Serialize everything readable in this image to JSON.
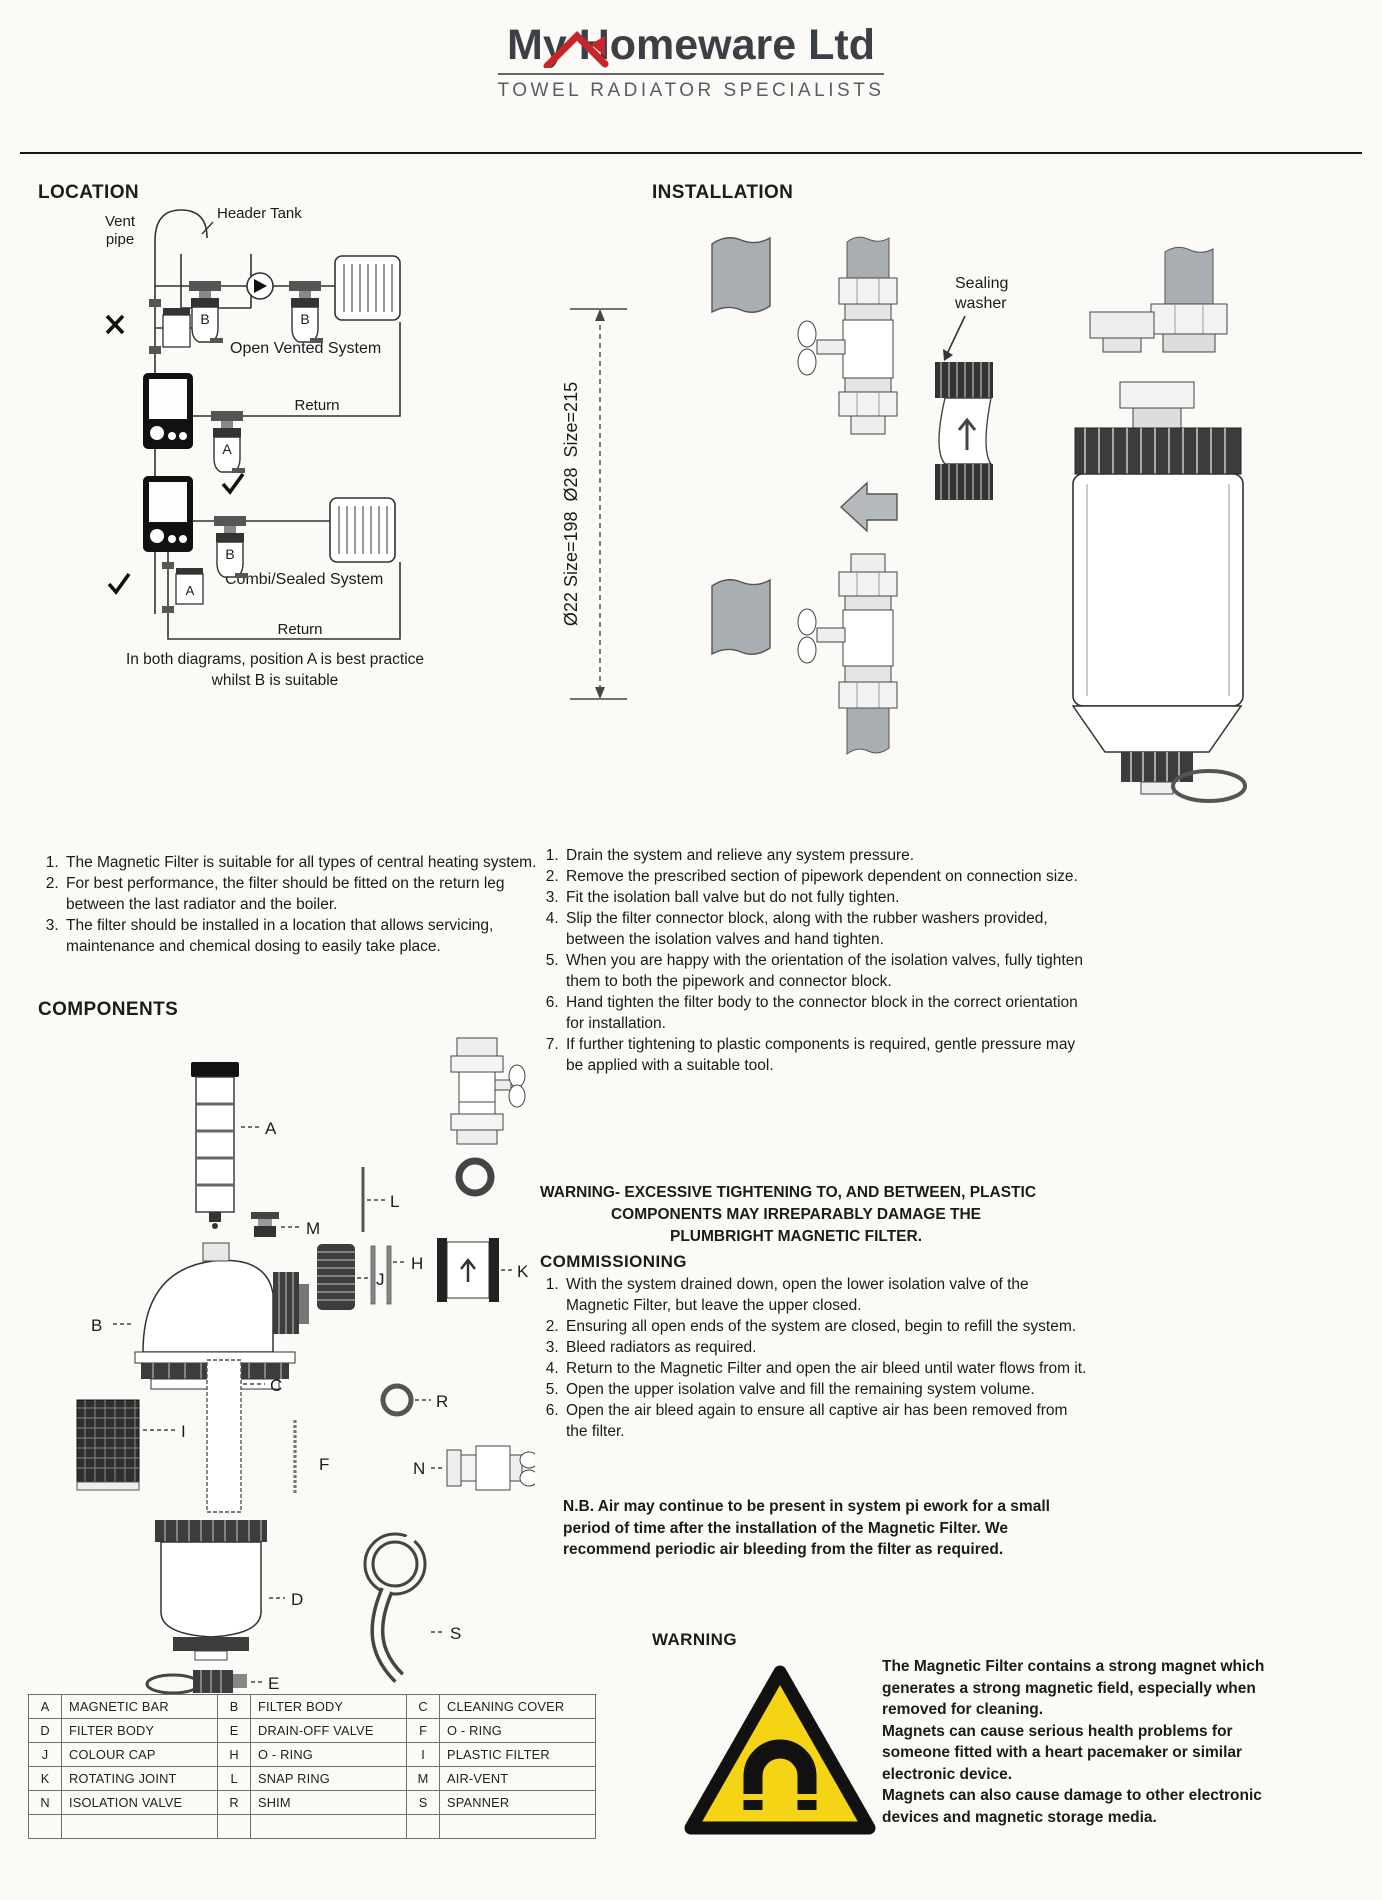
{
  "header": {
    "brand": "My Homeware Ltd",
    "tagline": "TOWEL RADIATOR SPECIALISTS"
  },
  "location": {
    "title": "LOCATION",
    "diagram": {
      "vent_line1": "Vent",
      "vent_line2": "pipe",
      "header_tank": "Header Tank",
      "open_vented_system": "Open Vented System",
      "return_top": "Return",
      "combi_sealed_system": "Combi/Sealed System",
      "return_bottom": "Return",
      "filter_b1": "B",
      "filter_b2": "B",
      "filter_a1": "A",
      "filter_b3": "B",
      "filter_a2": "A"
    },
    "caption": [
      "In both diagrams, position A is best practice",
      "whilst B is suitable"
    ],
    "notes": [
      "The Magnetic Filter is suitable for all types of central heating system.",
      "For best performance, the filter should be fitted on the return leg between the last radiator and the boiler.",
      "The filter should be installed in a location that allows servicing, maintenance and chemical dosing to easily take place."
    ]
  },
  "installation": {
    "title": "INSTALLATION",
    "diagram": {
      "sealing_line1": "Sealing",
      "sealing_line2": "washer",
      "dimension": "Ø22 Size=198  Ø28  Size=215"
    },
    "steps": [
      "Drain the system and relieve any system pressure.",
      "Remove the prescribed section of pipework dependent on connection size.",
      "Fit the isolation ball valve but do not fully tighten.",
      "Slip the filter connector block, along with the rubber washers provided, between the isolation valves and hand tighten.",
      "When you are happy with the orientation of the isolation valves, fully tighten them to both the pipework and connector block.",
      "Hand tighten the filter body to the connector block in the correct orientation for installation.",
      "If further tightening to plastic components is required, gentle pressure may be applied with a suitable tool."
    ]
  },
  "warning_tightening": {
    "lines": [
      "WARNING- EXCESSIVE TIGHTENING TO, AND BETWEEN, PLASTIC",
      "COMPONENTS MAY IRREPARABLY DAMAGE THE",
      "PLUMBRIGHT MAGNETIC FILTER."
    ]
  },
  "commissioning": {
    "title": "COMMISSIONING",
    "steps": [
      "With the system drained down, open the lower isolation valve of the Magnetic Filter, but leave the upper closed.",
      "Ensuring all open ends of the system are closed, begin to refill the system.",
      "Bleed radiators as required.",
      "Return to the Magnetic Filter and open the air bleed until water flows from it.",
      "Open the upper isolation valve and fill the remaining system volume.",
      "Open the air bleed again to ensure all captive air has been removed from the filter."
    ],
    "nb": "N.B. Air may continue to be present in system pi ework for a small period of time after the installation of the Magnetic Filter. We recommend periodic air bleeding from the filter as required."
  },
  "components": {
    "title": "COMPONENTS",
    "labels": {
      "a": "A",
      "m": "M",
      "b": "B",
      "l": "L",
      "j": "J",
      "h": "H",
      "k": "K",
      "i": "I",
      "c": "C",
      "f": "F",
      "r": "R",
      "n": "N",
      "d": "D",
      "e": "E",
      "s": "S"
    },
    "table_rows": [
      [
        "A",
        "MAGNETIC BAR",
        "B",
        "FILTER BODY",
        "C",
        "CLEANING COVER"
      ],
      [
        "D",
        "FILTER BODY",
        "E",
        "DRAIN-OFF VALVE",
        "F",
        "O - RING"
      ],
      [
        "J",
        "COLOUR CAP",
        "H",
        "O - RING",
        "I",
        "PLASTIC FILTER"
      ],
      [
        "K",
        "ROTATING JOINT",
        "L",
        "SNAP RING",
        "M",
        "AIR-VENT"
      ],
      [
        "N",
        "ISOLATION VALVE",
        "R",
        "SHIM",
        "S",
        "SPANNER"
      ],
      [
        "",
        "",
        "",
        "",
        "",
        ""
      ]
    ]
  },
  "warning_magnet": {
    "title": "WARNING",
    "paragraphs": [
      "The Magnetic Filter contains a strong magnet which generates a strong magnetic field, especially when removed for cleaning.",
      "Magnets can cause serious health problems for someone fitted with a heart pacemaker or similar electronic device.",
      "Magnets can also cause damage to other electronic devices and magnetic storage media."
    ],
    "colors": {
      "triangle_yellow": "#f4d414",
      "brand_red": "#c9252b"
    }
  }
}
